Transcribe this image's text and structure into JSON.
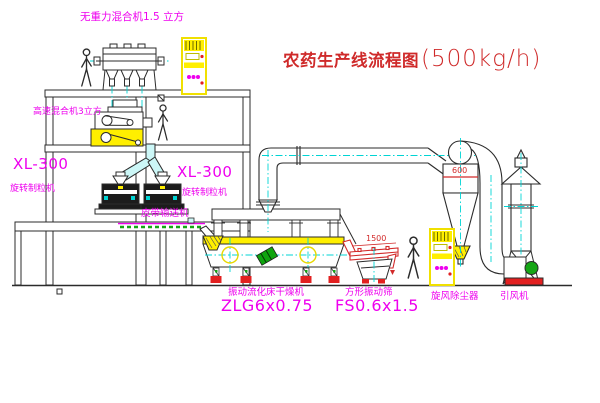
{
  "diagram": {
    "title": {
      "name": "农药生产线流程图",
      "capacity": "(500kg/h)"
    },
    "equipment_labels": {
      "gravity_mixer": "无重力混合机1.5 立方",
      "high_speed_mixer": "高速混合机3立方",
      "granulator_left": {
        "model": "XL-300",
        "name": "旋转制粒机"
      },
      "granulator_right": {
        "model": "XL-300",
        "name": "旋转制粒机"
      },
      "belt_conveyor": "皮带输送机",
      "fluid_bed_dryer": {
        "name": "振动流化床干燥机",
        "model": "ZLG6x0.75"
      },
      "vibrating_screen": {
        "name": "方形振动筛",
        "model": "FS0.6x1.5"
      },
      "cyclone": "旋风除尘器",
      "induced_draft_fan": "引风机"
    },
    "dimensions": {
      "cyclone": "600",
      "screen": "1500"
    },
    "colors": {
      "line": "#2b2b2b",
      "centerline": "#00d4d4",
      "label": "#ee00ee",
      "annotation": "#d22a2a",
      "equipment_fill": "#ffef00",
      "motor_green": "#16a616"
    }
  }
}
